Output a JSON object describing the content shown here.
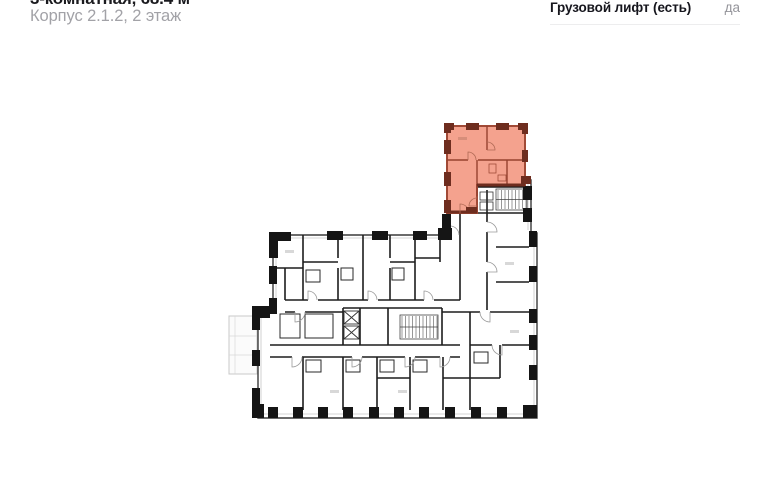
{
  "header": {
    "title": "3-комнатная, 68.4 м²",
    "subtitle": "Корпус 2.1.2, 2 этаж"
  },
  "specs": {
    "rows": [
      {
        "label": "Грузовой лифт (есть)",
        "value": "да"
      }
    ]
  },
  "plan": {
    "description": "floor-plan",
    "colors": {
      "highlight_fill": "#f4a28e",
      "highlight_wall": "#6e2d1f",
      "highlight_line": "#96422f",
      "highlight_arc": "#b06a55",
      "wall": "#1d1d1d",
      "pilaster": "#151515",
      "light": "#c7c7c7"
    }
  }
}
